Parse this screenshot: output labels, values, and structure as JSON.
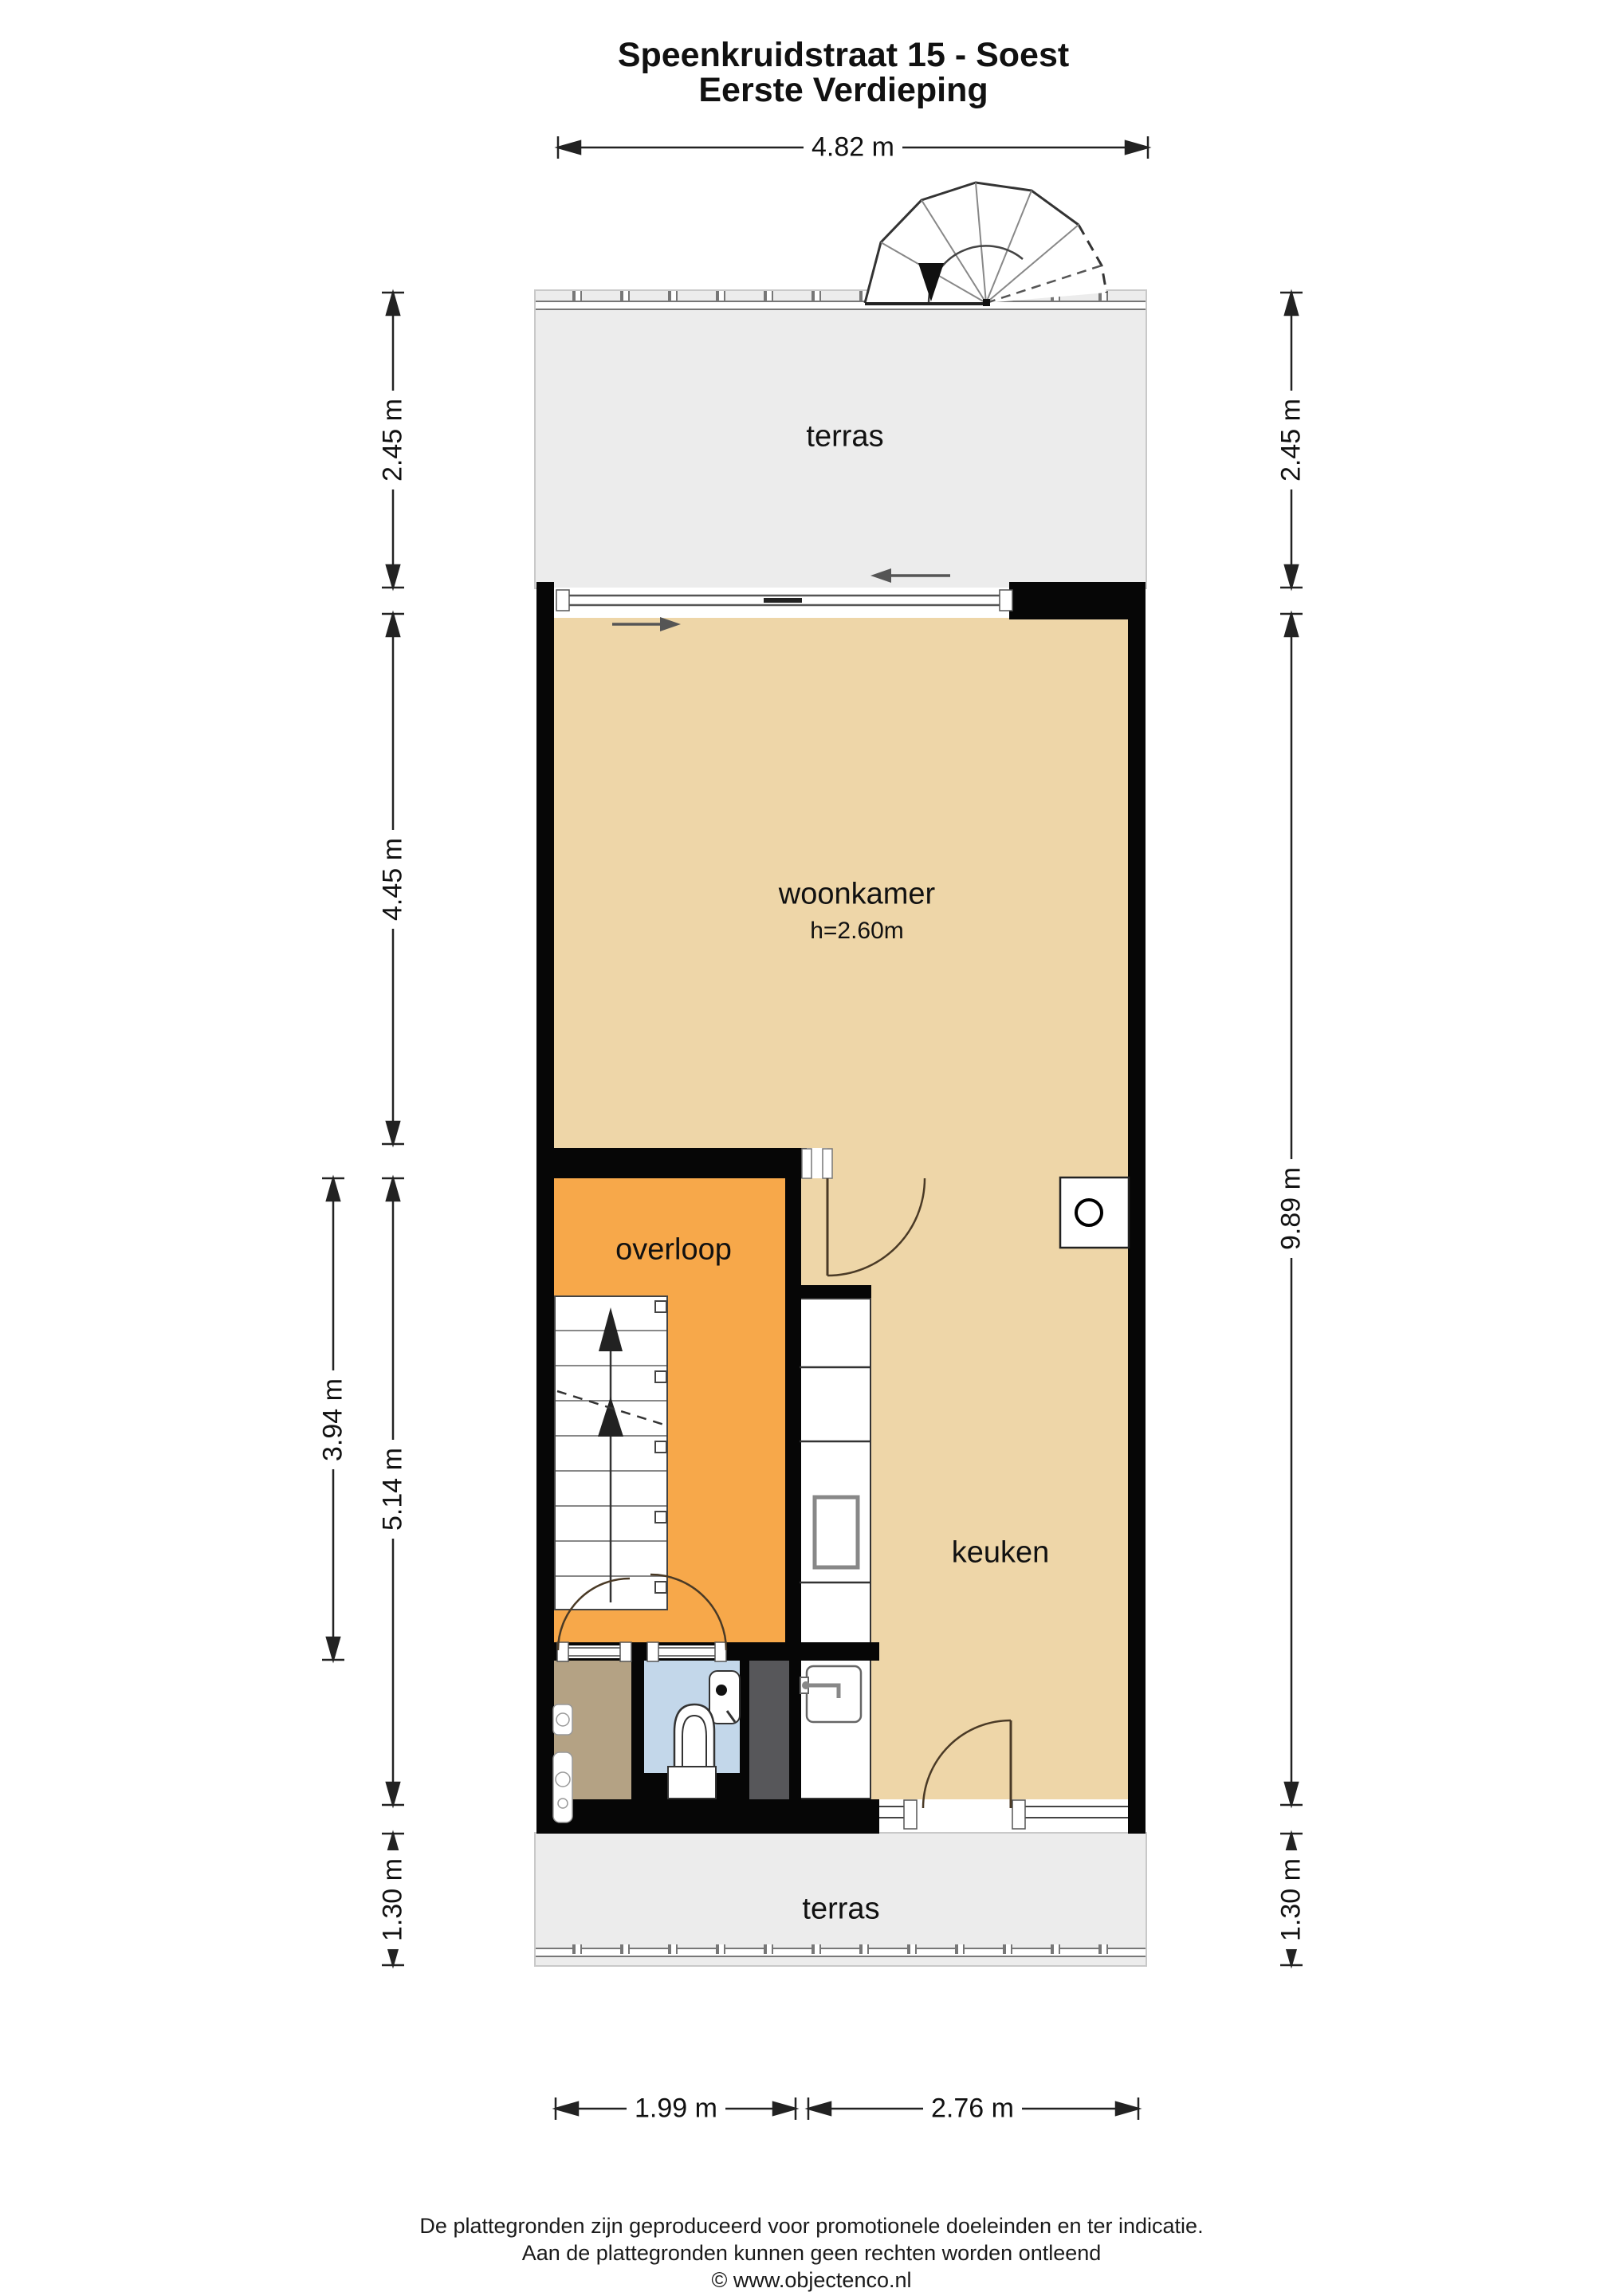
{
  "title": {
    "line1": "Speenkruidstraat 15 - Soest",
    "line2": "Eerste Verdieping"
  },
  "rooms": {
    "terrace_top": "terras",
    "living": "woonkamer",
    "living_height": "h=2.60m",
    "landing": "overloop",
    "kitchen": "keuken",
    "terrace_bottom": "terras"
  },
  "dimensions": {
    "top_width": "4.82 m",
    "left_terrace_top": "2.45 m",
    "left_living": "4.45 m",
    "left_stairs": "3.94 m",
    "left_landing": "5.14 m",
    "left_terrace_bottom": "1.30 m",
    "right_terrace_top": "2.45 m",
    "right_main": "9.89 m",
    "right_terrace_bottom": "1.30 m",
    "bottom_left": "1.99 m",
    "bottom_right": "2.76 m"
  },
  "footer": {
    "line1": "De plattegronden zijn geproduceerd voor promotionele doeleinden en ter indicatie.",
    "line2": "Aan de plattegronden kunnen geen rechten worden ontleend",
    "line3": "© www.objectenco.nl"
  },
  "colors": {
    "floor_beige": "#eed6a8",
    "landing_orange": "#f7a84a",
    "terrace_grey": "#ececec",
    "storage_brown": "#b4a284",
    "toilet_blue": "#c3d7ea",
    "shaft_grey": "#57575a",
    "wall_black": "#060606"
  }
}
